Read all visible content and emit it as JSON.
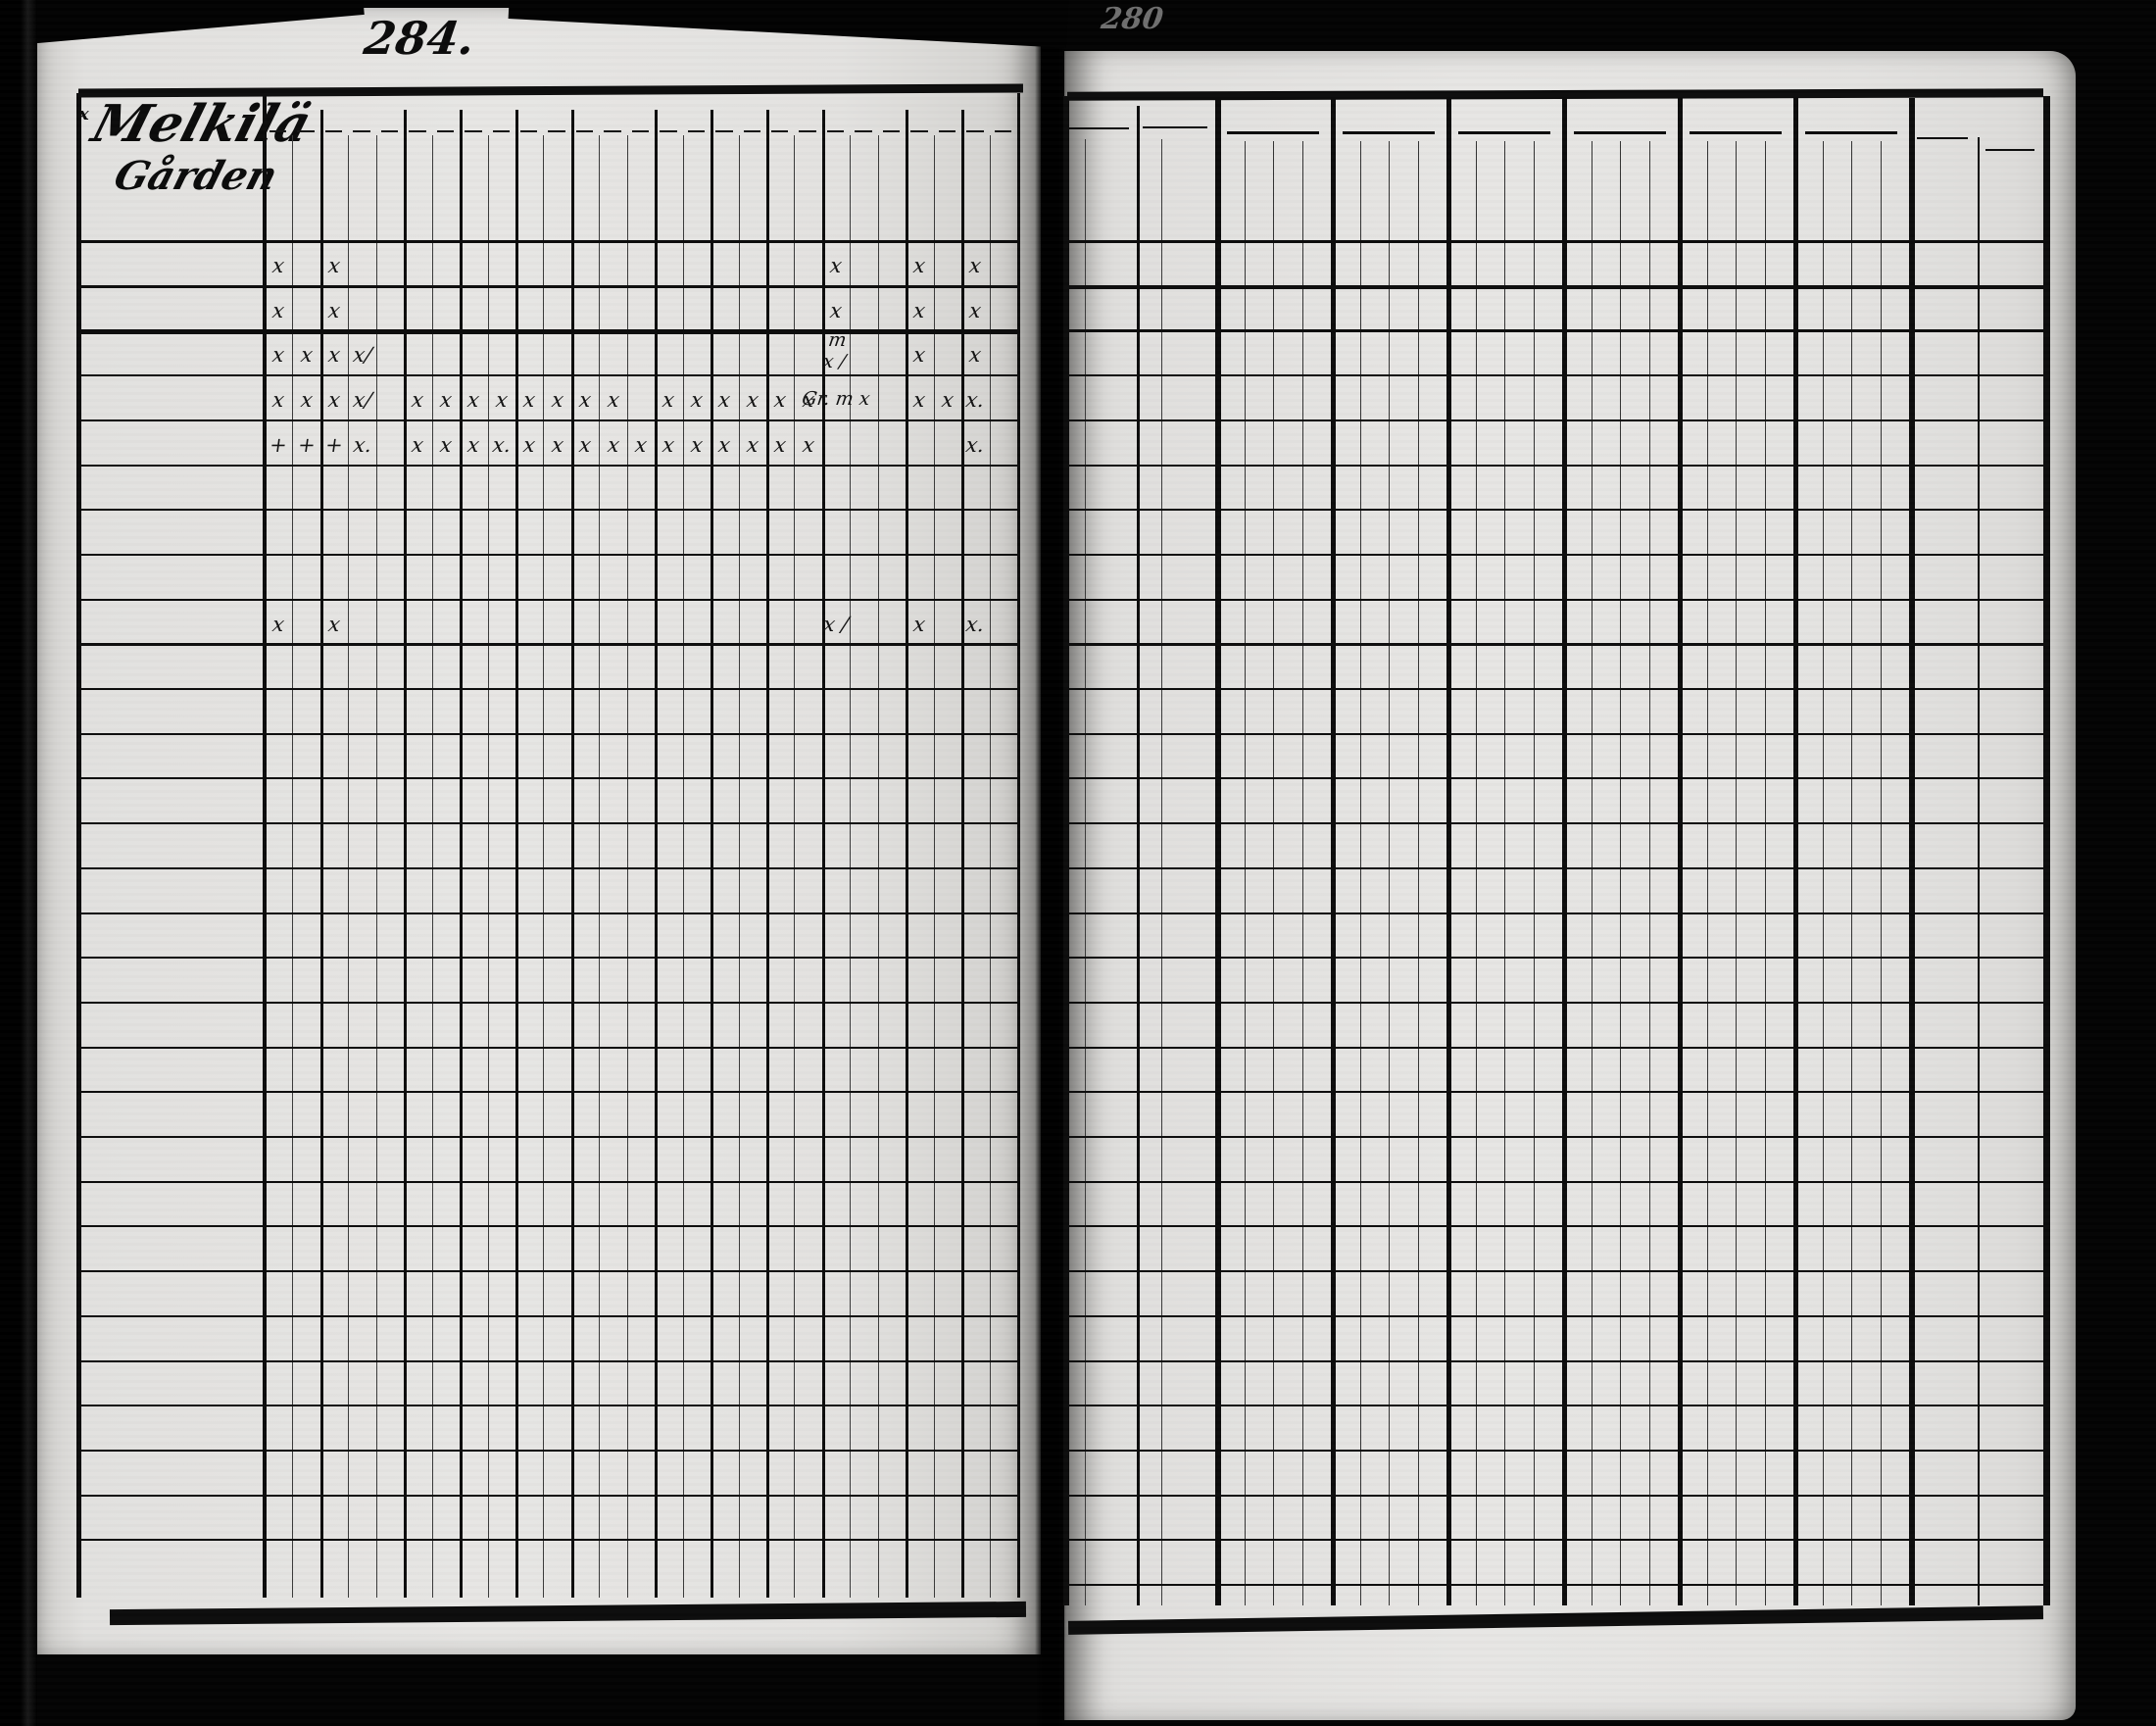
{
  "scan": {
    "left_page_number": "284.",
    "right_page_number_faint": "280"
  },
  "left_page": {
    "farm_name": [
      "Melkilä",
      "Gården"
    ],
    "corner_mark": "x",
    "header_groups": [
      {
        "label": "Dec.",
        "subs": [
          "Simpl.",
          "Explic."
        ]
      },
      {
        "label": "Symb.",
        "subs": [
          "Simpl.",
          "Explic.",
          "Athan."
        ]
      },
      {
        "label": "Or.L",
        "subs": [
          "Simpl.",
          "Explic."
        ]
      },
      {
        "label": "Bapt.",
        "subs": [
          "Simpl.",
          "Explic."
        ]
      },
      {
        "label": "Abſ.",
        "subs": [
          "Simpl.",
          "Explic."
        ]
      },
      {
        "label": "Conf.",
        "subs": [
          "1.",
          "2.",
          "3."
        ]
      },
      {
        "label": "C. D.",
        "subs": [
          "Simpl.",
          "Explic."
        ]
      },
      {
        "label": "Menſ.",
        "subs": [
          "Bened.",
          "Grat. a"
        ]
      },
      {
        "label": "Orat",
        "subs": [
          "Matut.",
          "Veſpert."
        ]
      },
      {
        "label": "Quæſt.",
        "subs": [
          "Aliq. m.",
          "Plenius.",
          "Dict.s.s."
        ]
      },
      {
        "label": "T.æc.",
        "subs": [
          "Aliq. m.",
          "Plenius."
        ]
      },
      {
        "label": "L.n.",
        "subs": [
          "Aliq. m.",
          "Exact."
        ]
      }
    ],
    "rows": [
      {
        "row": 0,
        "name": "B: Gabriel Mårtenson",
        "cells": {
          "0": "x",
          "2": "x",
          "20": "x",
          "23": "x",
          "25": "x"
        }
      },
      {
        "row": 1,
        "name": "H:K: Anna Johansd:r",
        "margin": "+",
        "cells": {
          "0": "x",
          "2": "x",
          "20": "x",
          "23": "x",
          "25": "x"
        }
      },
      {
        "row": 2,
        "name": "Henric Son",
        "annotation": "adm. 1804:",
        "cells": {
          "0": "x",
          "1": "x",
          "2": "x",
          "3": "x/",
          "20": "m\nx /",
          "23": "x",
          "25": "x"
        }
      },
      {
        "row": 3,
        "name": "Mats Son",
        "annotation": "Adm Cond. 1806",
        "cells": {
          "0": "x",
          "1": "x",
          "2": "x",
          "3": "x/",
          "5": "x",
          "6": "x",
          "7": "x",
          "8": "x",
          "9": "x",
          "10": "x",
          "11": "x",
          "12": "x",
          "14": "x",
          "15": "x",
          "16": "x",
          "17": "x",
          "18": "x",
          "19": "x",
          "20": "Gr. m x",
          "23": "x",
          "24": "x",
          "25": "x."
        }
      },
      {
        "row": 4,
        "name": "Lisa Dotter",
        "cells": {
          "0": "+",
          "1": "+",
          "2": "+",
          "3": "x.",
          "5": "x",
          "6": "x",
          "7": "x",
          "8": "x.",
          "9": "x",
          "10": "x",
          "11": "x",
          "12": "x",
          "13": "x",
          "14": "x",
          "15": "x",
          "16": "x",
          "17": "x",
          "18": "x",
          "19": "x",
          "25": "x."
        }
      },
      {
        "row": 8,
        "name": "Enk. Sophia Andersd:r",
        "margin": "+",
        "annotations_above": [
          "mina",
          "Mor"
        ],
        "cells": {
          "0": "x",
          "2": "x",
          "20": "x /",
          "23": "x",
          "25": "x."
        }
      }
    ]
  },
  "right_page": {
    "header": {
      "natus": "Natus.",
      "obiit": "Obiit",
      "d": "D.",
      "anno": "Anno.",
      "years": [
        "1804",
        "1805",
        "1806",
        "1807",
        "1808",
        "1809"
      ],
      "acces": "Acceſ.",
      "abit": "Abit."
    },
    "rows": [
      {
        "row": 0,
        "natus": "1750",
        "y1804": "15 21",
        "y1805": "31 1",
        "y1806": "15 30",
        "y1807": "7 8/11",
        "y1808": "8/3 27/11",
        "y1809": "4/6 23/10",
        "acces": "45k\n245",
        "abit": "ur\n351"
      },
      {
        "row": 1,
        "natus": "1761",
        "obiit": "1808",
        "y1804": "4/10 d 2",
        "y1805": "5/2 d 12",
        "y1806": "5/3 d d",
        "y1807": "5/8 d d",
        "y1808": "d 3"
      },
      {
        "row": 2,
        "natus": "1787",
        "y1804": "9",
        "y1805": "d d",
        "y1806": "d 8",
        "y1807": "d d",
        "y1808": "3 5",
        "y1809": "d d"
      },
      {
        "row": 3,
        "natus": "1790",
        "y1806": "2.",
        "y1807": "d d",
        "y1808": "3c",
        "y1809": "d d"
      },
      {
        "row": 4,
        "natus": "1796"
      },
      {
        "row": 8,
        "natus": "1719",
        "obiit_d": "20/9",
        "obiit": "1807.",
        "obiit_note": "71/2\n8o",
        "y1804": "d 4/11",
        "y1805": "30/5",
        "y1806": "d d"
      }
    ]
  }
}
